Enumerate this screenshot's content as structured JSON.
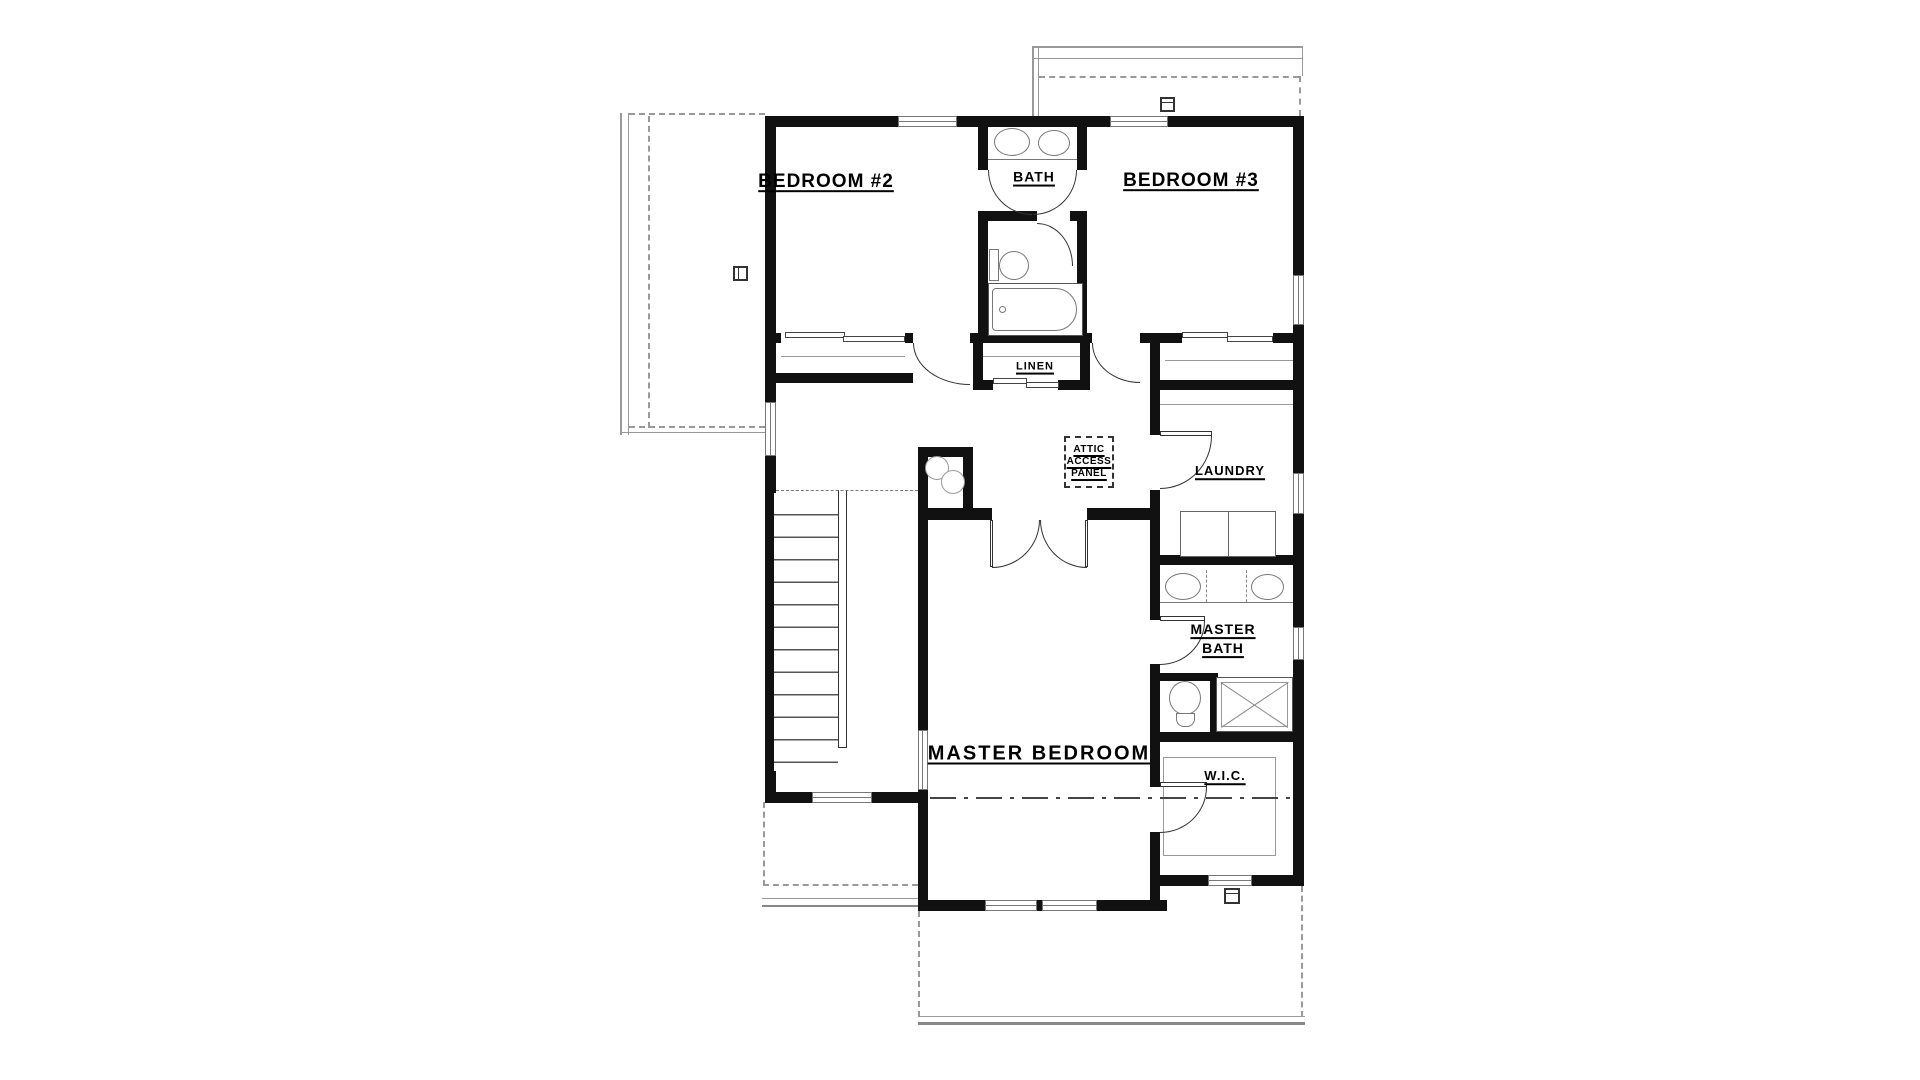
{
  "labels": {
    "bedroom2": "BEDROOM #2",
    "bath": "BATH",
    "bedroom3": "BEDROOM #3",
    "linen": "LINEN",
    "attic_access": "ATTIC\nACCESS\nPANEL",
    "laundry": "LAUNDRY",
    "master_bath": "MASTER\nBATH",
    "master_bedroom": "MASTER BEDROOM",
    "wic": "W.I.C."
  },
  "colors": {
    "wall": "#111111",
    "fixture_line": "#777777",
    "roof_line": "#999999",
    "text": "#000000"
  }
}
